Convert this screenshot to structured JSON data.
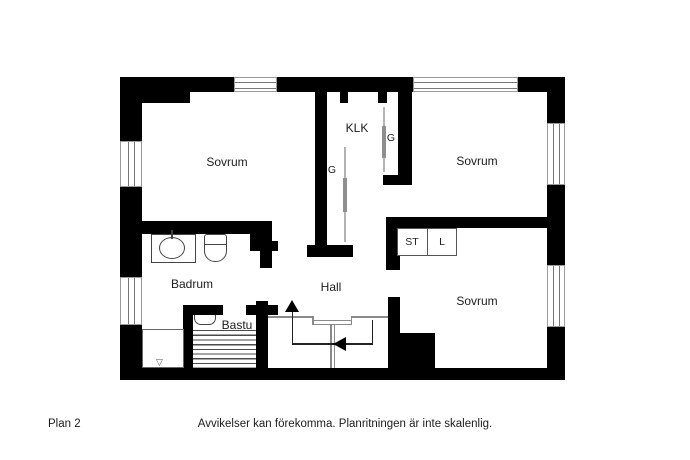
{
  "plan": {
    "floor_label": "Plan 2",
    "disclaimer": "Avvikelser kan förekomma. Planritningen är inte skalenlig."
  },
  "rooms": {
    "bedroom_top_left": "Sovrum",
    "bedroom_top_right": "Sovrum",
    "bedroom_bottom_right": "Sovrum",
    "walk_in_closet": "KLK",
    "wardrobe_left": "G",
    "wardrobe_right": "G",
    "cleaning_closet": "ST",
    "linen_closet": "L",
    "bathroom": "Badrum",
    "sauna": "Bastu",
    "hall": "Hall"
  },
  "symbols": {
    "floor_drain": "▽"
  },
  "colors": {
    "background": "#ffffff",
    "wall": "#000000",
    "window_line": "#777777",
    "stair_line": "#8a8a8a",
    "fixture_line": "#444444",
    "text": "#1c1c1c"
  }
}
